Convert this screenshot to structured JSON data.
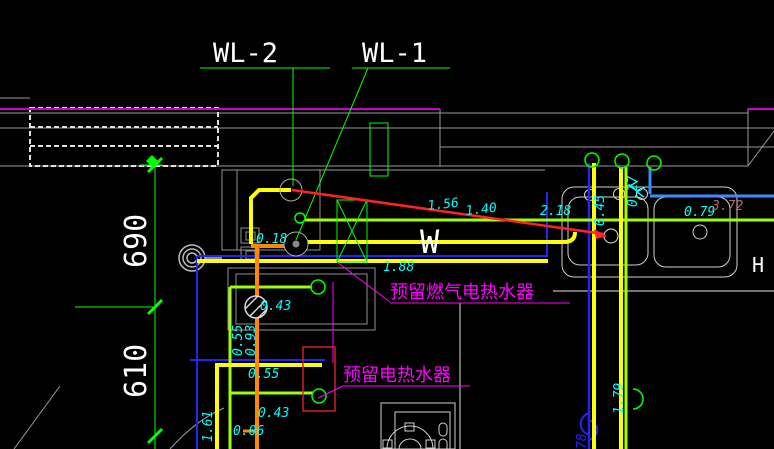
{
  "drawing": {
    "risers": {
      "wl2": "WL-2",
      "wl1": "WL-1"
    },
    "dimensions": {
      "d690": "690",
      "d610": "610"
    },
    "system_letter": "W",
    "notes": {
      "gas_heater": "预留燃气电热水器",
      "electric_heater": "预留电热水器"
    },
    "elevations": {
      "e018": "0.18",
      "e156": "1.56",
      "e140": "1.40",
      "e218": "2.18",
      "e045": "0.45",
      "e027": "0.27",
      "e079": "0.79",
      "e372": "3.72",
      "e188": "1.88",
      "e043a": "0.43",
      "e055v": "0.55",
      "e093": "0.93",
      "e055h": "0.55",
      "e043b": "0.43",
      "e006": "0.06",
      "e161": "1.61",
      "e179": "1.79",
      "e278": "78"
    },
    "partial_text_right": "H",
    "colors": {
      "background": "#000000",
      "yellow_pipe": "#ffff00",
      "orange_pipe": "#ff8800",
      "chartreuse_pipe": "#9dff00",
      "dark_blue_pipe": "#2222ff",
      "bright_blue_pipe": "#3c8cff",
      "red_leader": "#ff2222",
      "cyan_annotation": "#00ffff",
      "magenta_note": "#ff00ff",
      "green_dimension": "#00ff00",
      "wall_gray": "#9a9a9a",
      "white_text": "#ffffff",
      "dark_red_annotation": "#bb6666"
    }
  }
}
